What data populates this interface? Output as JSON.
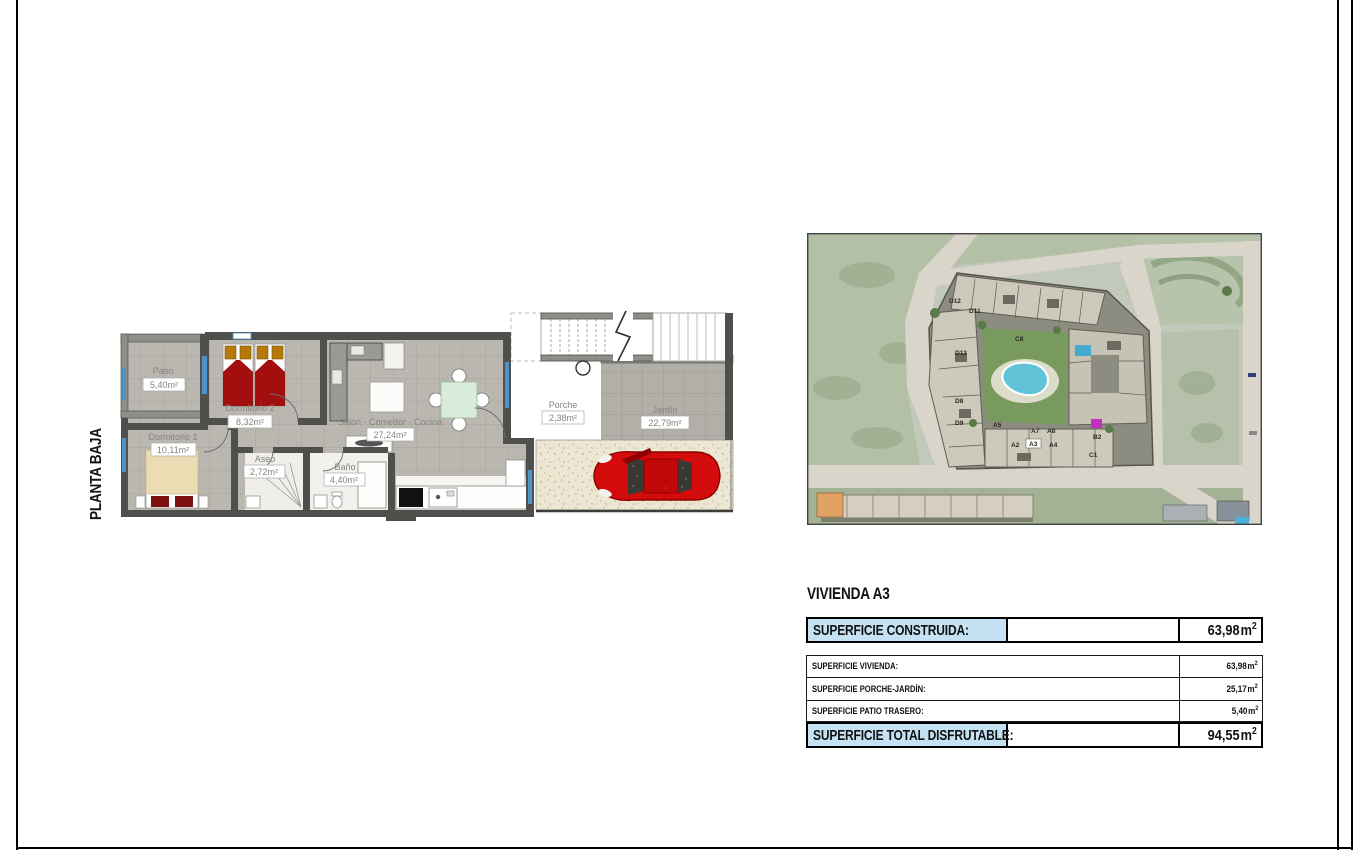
{
  "floor_plan": {
    "title": "PLANTA BAJA",
    "rooms": [
      {
        "name": "Patio",
        "area": "5,40m²"
      },
      {
        "name": "Dormitorio 2",
        "area": "8,32m²"
      },
      {
        "name": "Dormitorio 1",
        "area": "10,11m²"
      },
      {
        "name": "Aseo",
        "area": "2,72m²"
      },
      {
        "name": "Baño",
        "area": "4,40m²"
      },
      {
        "name": "Salón - Comedor - Cocina",
        "area": "27,24m²"
      },
      {
        "name": "Porche",
        "area": "2,38m²"
      },
      {
        "name": "Jardín",
        "area": "22,79m²"
      }
    ]
  },
  "site_map": {
    "building_labels": [
      "D12",
      "D11",
      "C8",
      "D13",
      "D8",
      "D9",
      "A5",
      "A2",
      "A7",
      "A3",
      "A8",
      "A4",
      "B2",
      "C1"
    ],
    "colors": {
      "park": "#b3c0a6",
      "road": "#d9d5cb",
      "parcel": "#8c8c80",
      "building": "#cdc9bb",
      "courtyard": "#789a5e",
      "pool": "#62c3d8"
    }
  },
  "summary": {
    "title": "VIVIENDA A3",
    "highlight_color": "#c5e2f4",
    "rows": [
      {
        "label": "SUPERFICIE CONSTRUIDA:",
        "value": "63,98",
        "unit": "m",
        "sup": "2"
      },
      {
        "label": "SUPERFICIE VIVIENDA:",
        "value": "63,98",
        "unit": "m",
        "sup": "2"
      },
      {
        "label": "SUPERFICIE PORCHE-JARDÍN:",
        "value": "25,17",
        "unit": "m",
        "sup": "2"
      },
      {
        "label": "SUPERFICIE PATIO TRASERO:",
        "value": "5,40",
        "unit": "m",
        "sup": "2"
      },
      {
        "label": "SUPERFICIE TOTAL DISFRUTABLE:",
        "value": "94,55",
        "unit": "m",
        "sup": "2"
      }
    ]
  }
}
